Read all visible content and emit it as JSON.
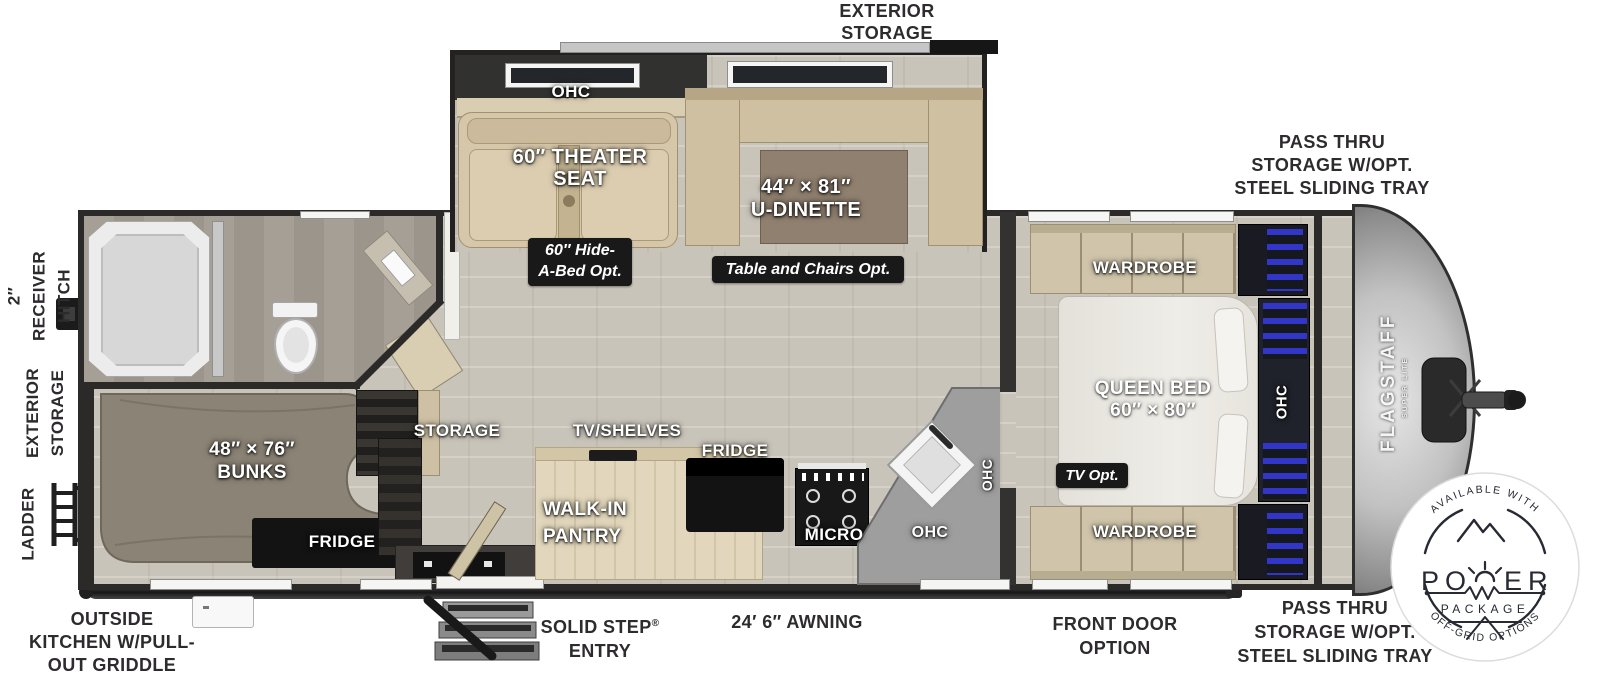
{
  "annotations": {
    "exterior_storage_top": [
      "EXTERIOR",
      "STORAGE"
    ],
    "pass_thru_top": [
      "PASS THRU",
      "STORAGE W/OPT.",
      "STEEL SLIDING TRAY"
    ],
    "pass_thru_bottom": [
      "PASS THRU",
      "STORAGE W/OPT.",
      "STEEL SLIDING TRAY"
    ],
    "receiver_hitch": [
      "2″",
      "RECEIVER",
      "HITCH"
    ],
    "exterior_storage_left": [
      "EXTERIOR",
      "STORAGE"
    ],
    "ladder": "LADDER",
    "outside_kitchen": [
      "OUTSIDE",
      "KITCHEN W/PULL-",
      "OUT GRIDDLE"
    ],
    "solid_step": {
      "name": "SOLID STEP",
      "reg": "®",
      "line2": "ENTRY"
    },
    "awning": "24′ 6″ AWNING",
    "front_door": [
      "FRONT DOOR",
      "OPTION"
    ]
  },
  "living": {
    "ohc": "OHC",
    "theater_seat": [
      "60″ THEATER",
      "SEAT"
    ],
    "dinette": [
      "44″ × 81″",
      "U-DINETTE"
    ],
    "hide_a_bed_badge": [
      "60″ Hide-",
      "A-Bed Opt."
    ],
    "table_chairs_badge": "Table and Chairs Opt."
  },
  "rear": {
    "bunks": [
      "48″ × 76″",
      "BUNKS"
    ],
    "fridge": "FRIDGE"
  },
  "kitchen": {
    "storage": "STORAGE",
    "tv_shelves": "TV/SHELVES",
    "fridge": "FRIDGE",
    "pantry": [
      "WALK-IN",
      "PANTRY"
    ],
    "micro": "MICRO",
    "ohc_lower": "OHC",
    "ohc_side": "OHC"
  },
  "bedroom": {
    "wardrobe_top": "WARDROBE",
    "queen_bed": [
      "QUEEN BED",
      "60″ × 80″"
    ],
    "ohc": "OHC",
    "tv_opt_badge": "TV Opt.",
    "wardrobe_bottom": "WARDROBE"
  },
  "brand": {
    "name": "FLAGSTAFF",
    "sub": "SUPER LITE"
  },
  "power_badge": {
    "top_arc": "AVAILABLE WITH",
    "word": "POWER",
    "word_left": "PO",
    "word_right": "ER",
    "package": "PACKAGE",
    "bottom_arc": "OFF-GRID OPTIONS"
  },
  "colors": {
    "annotation_text": "#2e2b2e",
    "plan_label_text": "#ffffff",
    "badge_bg": "#191919",
    "wall": "#2c2a28",
    "floor_wood": "#c9c4b9",
    "furniture_beige": "#d5c6a8",
    "bunk_gray": "#8b8375",
    "blue_accent": "#3c3fd6",
    "cap_silver": "#c9c9c9"
  }
}
